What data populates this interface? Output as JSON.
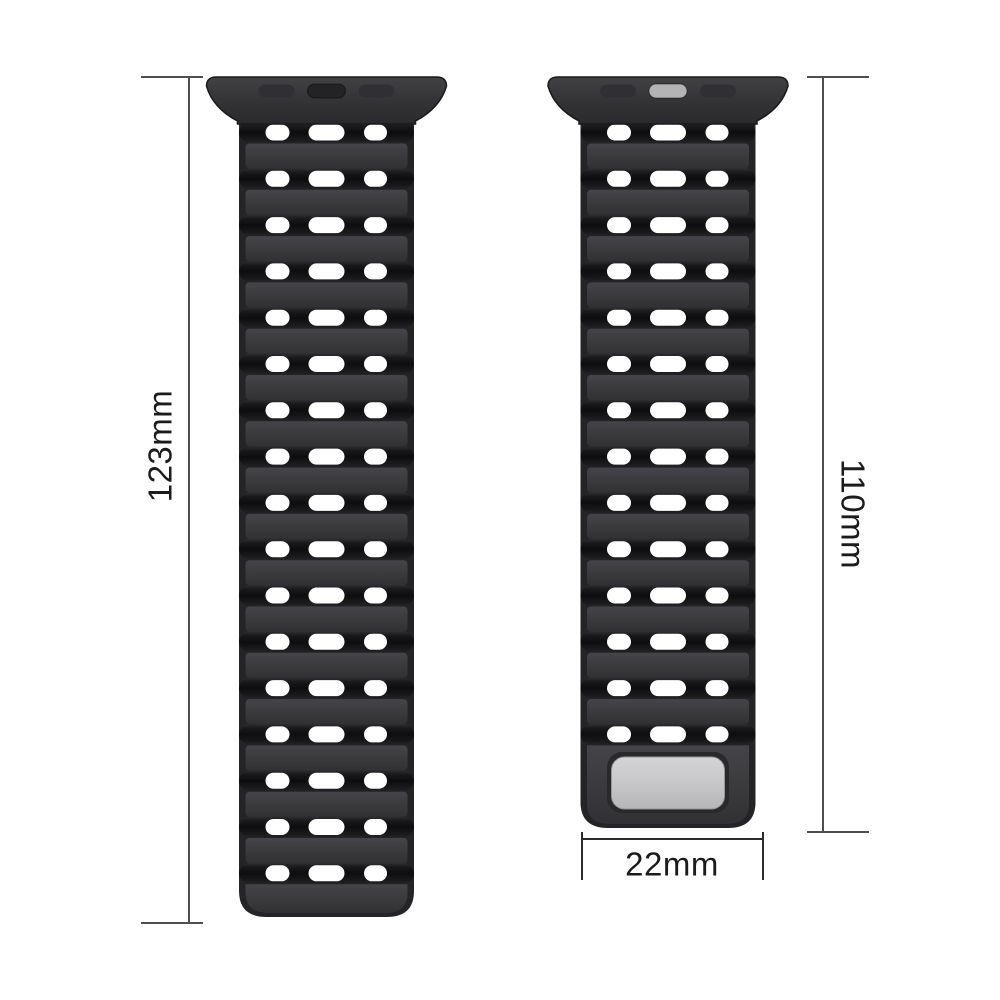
{
  "figure": {
    "description_role": "watch-strap-dimension-figure"
  },
  "product": {
    "left_strap": {
      "length_label": "123mm",
      "hole_rows": 17,
      "holes_per_row": 3,
      "metal_plate": false,
      "connector_slots": 3,
      "connector_center_slot": "dark"
    },
    "right_strap": {
      "length_label": "110mm",
      "hole_rows": 14,
      "holes_per_row": 3,
      "metal_plate": true,
      "connector_slots": 3,
      "connector_center_slot": "silver"
    },
    "width_label": "22mm"
  },
  "colors": {
    "background": "#ffffff",
    "strap_outline": "#242427",
    "strap_panel": "#3b3b3e",
    "strap_band": "#0d0d0f",
    "lug_face": "#353538",
    "hole": "#ffffff",
    "dark_slot": "#232326",
    "side_slot": "#303034",
    "silver_slot": "#b3b3b6",
    "metal_plate": "#c7c7c9",
    "plate_recess": "#29292c",
    "dimension_line": "#4e4e4e",
    "width_bracket_line": "#2c2c2c",
    "label_text": "#1b1b1b"
  }
}
